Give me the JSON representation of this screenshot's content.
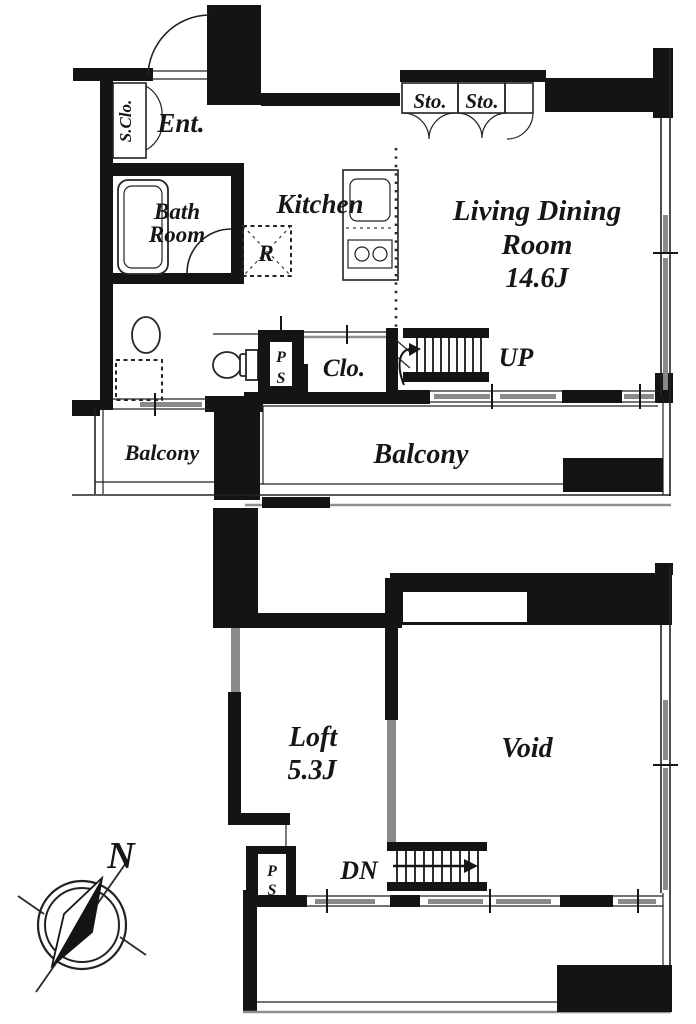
{
  "colors": {
    "wall": "#141414",
    "window_sash": "#8a8a8a",
    "background": "#ffffff"
  },
  "upper_floor": {
    "shoe_closet": "S.Clo.",
    "entrance": "Ent.",
    "bathroom": [
      "Bath",
      "Room"
    ],
    "kitchen": "Kitchen",
    "refrigerator": "R",
    "storage_left": "Sto.",
    "storage_right": "Sto.",
    "living_dining": [
      "Living Dining",
      "Room",
      "14.6J"
    ],
    "pipe_space": [
      "P",
      "S"
    ],
    "closet": "Clo.",
    "stairs_up": "UP",
    "balcony_small": "Balcony",
    "balcony_large": "Balcony"
  },
  "lower_floor": {
    "loft": [
      "Loft",
      "5.3J"
    ],
    "void": "Void",
    "stairs_down": "DN",
    "pipe_space": [
      "P",
      "S"
    ]
  },
  "compass": {
    "north": "N"
  }
}
